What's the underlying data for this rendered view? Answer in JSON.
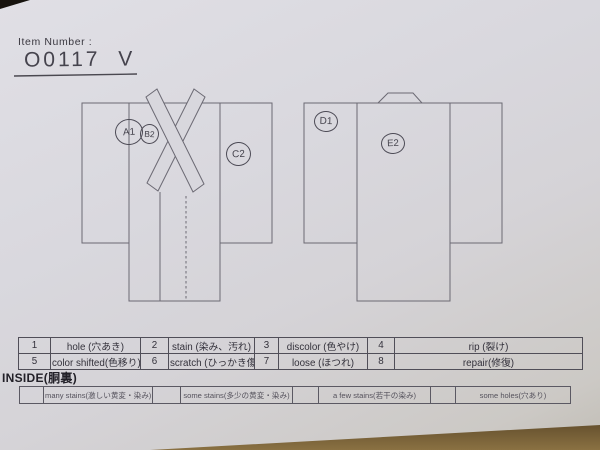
{
  "header": {
    "item_number_label": "Item Number :",
    "item_number_value": "O0117 V"
  },
  "diagram": {
    "front_view": "kimono-front",
    "back_view": "kimono-back",
    "markers": [
      "A1",
      "B2",
      "C2",
      "D1",
      "E2"
    ]
  },
  "defect_table": {
    "rows": [
      [
        "1",
        "hole (穴あき)",
        "2",
        "stain (染み、汚れ)",
        "3",
        "discolor (色やけ)",
        "4",
        "rip (裂け)"
      ],
      [
        "5",
        "color shifted(色移り)",
        "6",
        "scratch (ひっかき傷)",
        "7",
        "loose (ほつれ)",
        "8",
        "repair(修復)"
      ]
    ]
  },
  "inside_section": {
    "title": "INSIDE(胴裏)",
    "options": [
      "many stains(激しい黄変・染み)",
      "some stains(多少の黄変・染み)",
      "a few stains(若干の染み)",
      "some holes(穴あり)"
    ]
  },
  "colors": {
    "paper": "#d8d7dd",
    "background": "#221a10",
    "line": "#66646e",
    "ink": "#33313b"
  }
}
